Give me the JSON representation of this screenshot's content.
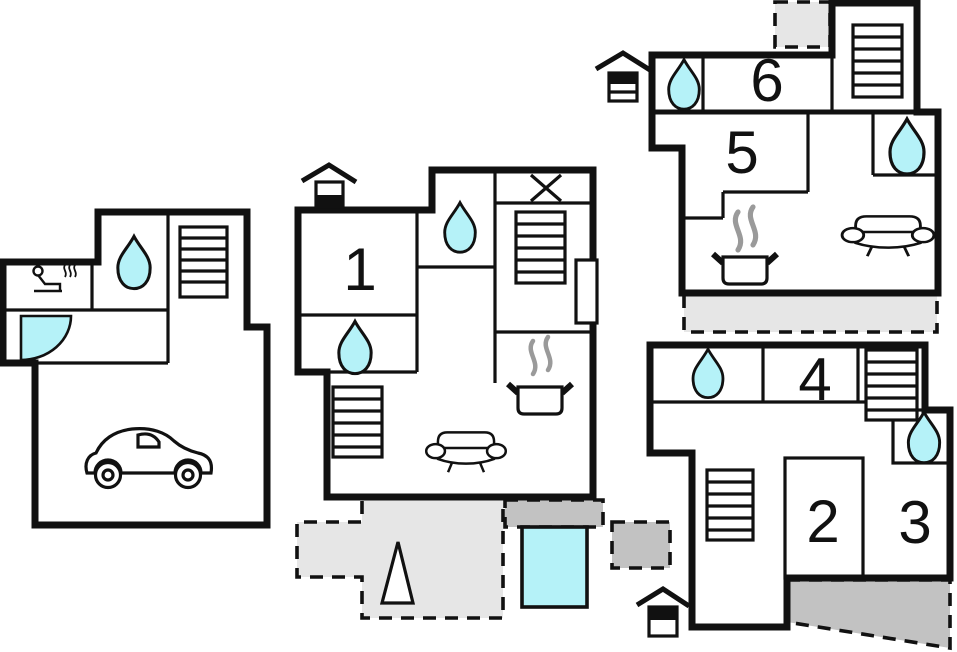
{
  "diagram": {
    "type": "floor-plan",
    "rooms": {
      "r1": "1",
      "r2": "2",
      "r3": "3",
      "r4": "4",
      "r5": "5",
      "r6": "6"
    },
    "colors": {
      "wall": "#111111",
      "water_feature": "#b5f2f8",
      "terrace_light": "#e6e6e6",
      "terrace_dark": "#c2c2c2",
      "steam": "#9a9a9a",
      "background": "#ffffff"
    },
    "icon_names": [
      "water-drop-icon",
      "stairs-icon",
      "sofa-icon",
      "stove-icon",
      "car-icon",
      "sauna-icon",
      "entrance-icon",
      "window-cross-icon",
      "door-swing-icon",
      "pool",
      "tree-icon",
      "terrace-area"
    ]
  }
}
